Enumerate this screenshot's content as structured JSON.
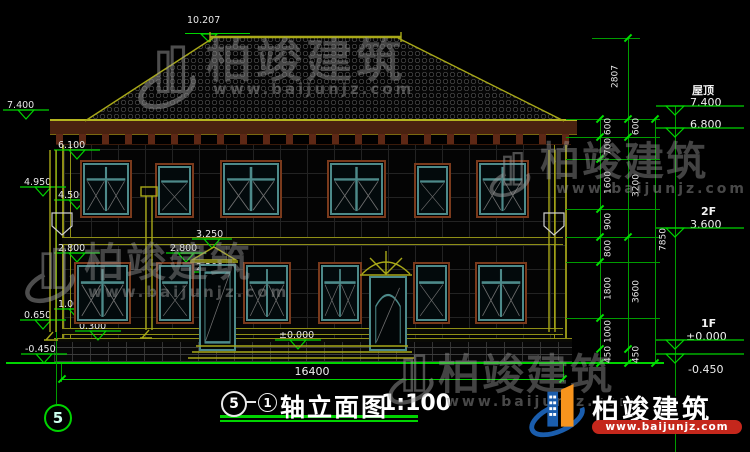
{
  "drawing": {
    "title": {
      "axis_start": "5",
      "axis_end": "1",
      "name": "轴立面图",
      "scale": "1:100"
    },
    "axis_bubble": "5",
    "total_width": "16400"
  },
  "left_markers": [
    "10.207",
    "7.400",
    "6.100",
    "4.950",
    "4.500",
    "2.800",
    "3.250",
    "2.800",
    "2.200",
    "1.000",
    "0.650",
    "0.300",
    "-0.450",
    "±0.000"
  ],
  "right_markers": [
    {
      "label": "屋顶",
      "value": "7.400"
    },
    {
      "label": "",
      "value": "6.800"
    },
    {
      "label": "2F",
      "value": "3.600"
    },
    {
      "label": "1F",
      "value": "±0.000"
    },
    {
      "label": "",
      "value": "-0.450"
    }
  ],
  "chain_a": [
    "600",
    "700",
    "1600",
    "900",
    "800",
    "1800",
    "1000",
    "450"
  ],
  "chain_b": [
    "2807",
    "600",
    "3200",
    "3600",
    "450"
  ],
  "chain_c": [
    "7850"
  ],
  "watermark": {
    "name": "柏竣建筑",
    "url": "www.baijunjz.com"
  },
  "brand": {
    "name": "柏竣建筑",
    "url": "www.baijunjz.com"
  },
  "colors": {
    "dim_green": "#00d400",
    "cad_yellow": "#8f8f16",
    "frame_teal": "#4d8a8a",
    "trim_brown": "#7a3a1c",
    "brand_blue": "#1a5dad",
    "brand_orange": "#f7941d",
    "brand_red": "#c4271c"
  }
}
